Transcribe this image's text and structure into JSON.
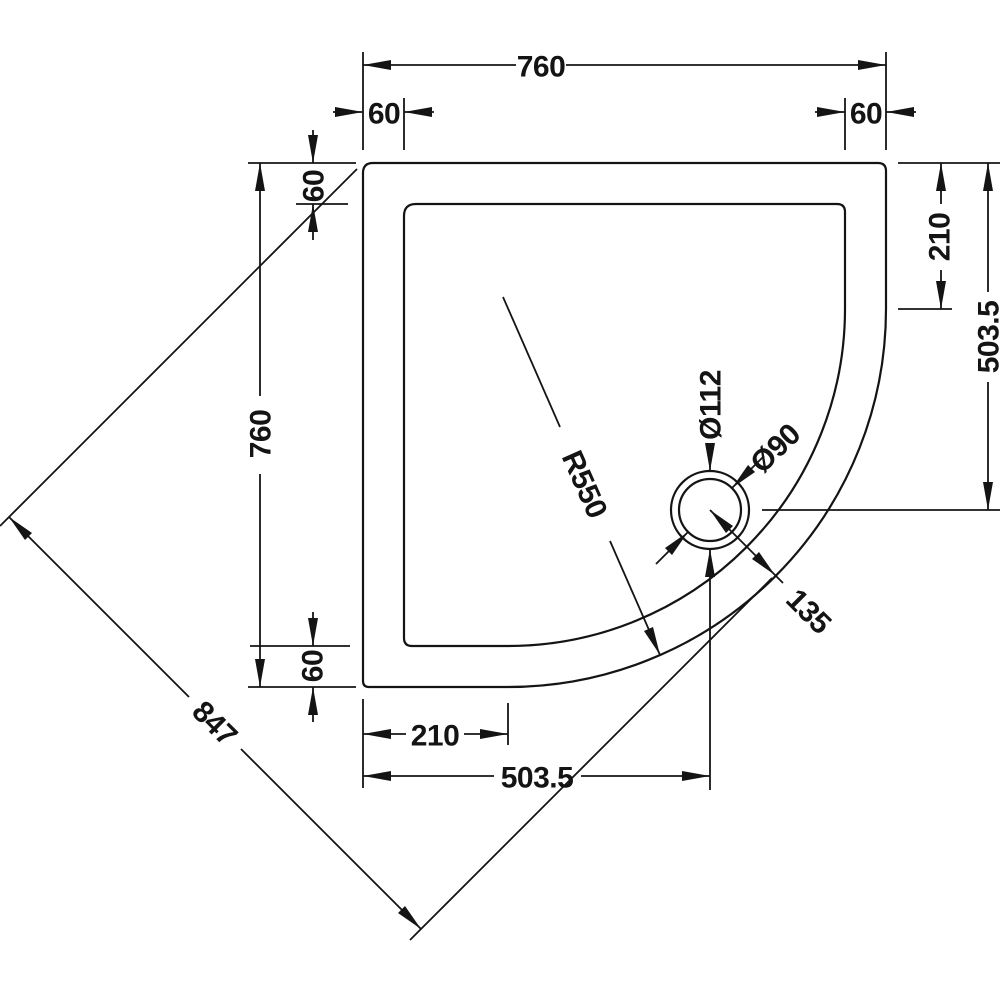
{
  "colors": {
    "background": "#ffffff",
    "line": "#141414"
  },
  "dimensions": {
    "top_width": "760",
    "top_left_rim": "60",
    "top_right_rim": "60",
    "left_height": "760",
    "left_top_rim": "60",
    "left_bottom_rim": "60",
    "right_straight_edge": "210",
    "right_waste_offset": "503.5",
    "bottom_straight_edge": "210",
    "bottom_waste_offset": "503.5",
    "diagonal": "847",
    "corner_radius": "R550",
    "waste_outer_dia": "Ø112",
    "waste_inner_dia": "Ø90",
    "waste_to_corner": "135"
  }
}
